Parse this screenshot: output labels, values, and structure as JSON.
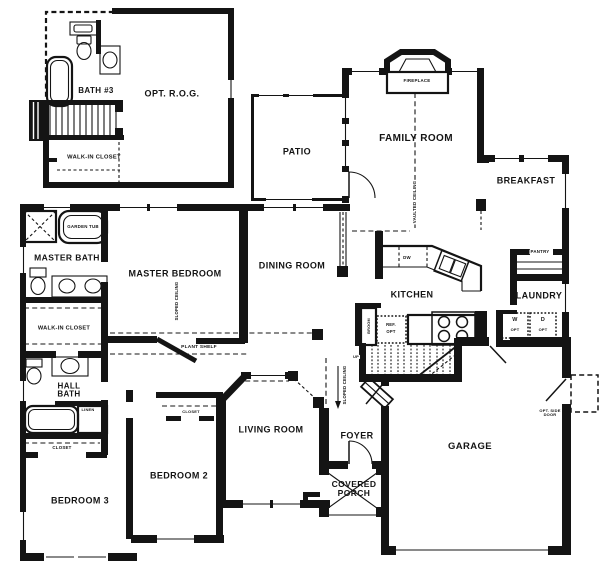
{
  "title": "House Floor Plan",
  "colors": {
    "ink": "#141414",
    "paper": "#ffffff"
  },
  "labels": {
    "bath3": "BATH #3",
    "opt_rog": "OPT. R.O.G.",
    "walk_in_closet_upper": "WALK-IN CLOSET",
    "patio": "PATIO",
    "fireplace": "FIREPLACE",
    "family_room": "FAMILY ROOM",
    "vaulted_ceiling": "VAULTED CEILING",
    "breakfast": "BREAKFAST",
    "pantry": "PANTRY",
    "laundry": "LAUNDRY",
    "washer": "W",
    "washer_opt": "OPT",
    "dryer": "D",
    "dryer_opt": "OPT",
    "kitchen": "KITCHEN",
    "dishwasher": "DW",
    "ref_line1": "REF.",
    "ref_line2": "OPT",
    "broom": "BROOM",
    "up": "UP",
    "sloped_ceiling_stairs": "SLOPED CEILING",
    "dining_room": "DINING ROOM",
    "master_bedroom": "MASTER BEDROOM",
    "sloped_ceiling_master": "SLOPED CEILING",
    "garden_tub": "GARDEN TUB",
    "master_bath": "MASTER BATH",
    "walk_in_closet_master": "WALK-IN CLOSET",
    "plant_shelf": "PLANT SHELF",
    "hall_bath_line1": "HALL",
    "hall_bath_line2": "BATH",
    "linen": "LINEN",
    "closet_bed3": "CLOSET",
    "bedroom3": "BEDROOM 3",
    "bedroom2": "BEDROOM 2",
    "closet_bed2": "CLOSET",
    "living_room": "LIVING ROOM",
    "foyer": "FOYER",
    "covered_porch_line1": "COVERED",
    "covered_porch_line2": "PORCH",
    "garage": "GARAGE",
    "opt_side_door_line1": "OPT. SIDE",
    "opt_side_door_line2": "DOOR"
  }
}
